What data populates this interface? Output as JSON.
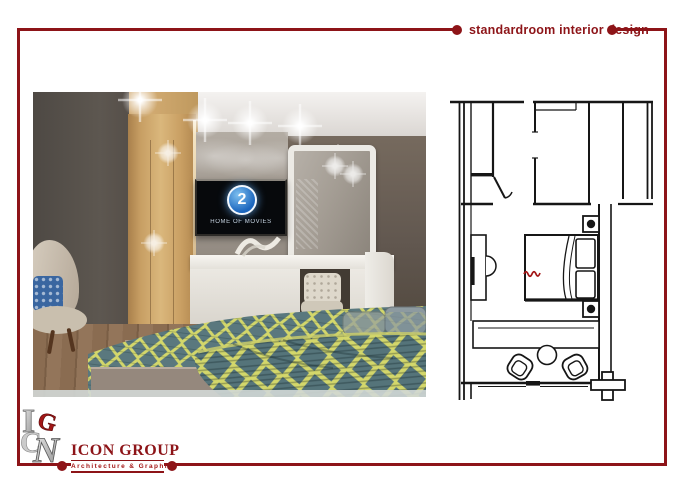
{
  "colors": {
    "accent": "#8d1418",
    "ink": "#161616",
    "logo-red": "#a31616",
    "tv-blue": "#1b65bd",
    "blanket-teal": "#5a787e",
    "blanket-yellow": "#d3d76b"
  },
  "header": {
    "title": "standardroom interior design"
  },
  "render": {
    "tv": {
      "channel_number": "2",
      "tagline": "HOME OF MOVIES"
    }
  },
  "logo": {
    "company_name": "ICON GROUP",
    "tagline": "Architecture & Graphics",
    "monogram": {
      "letter_i": "I",
      "letter_c": "C",
      "letter_g": "G",
      "letter_n": "N"
    }
  }
}
